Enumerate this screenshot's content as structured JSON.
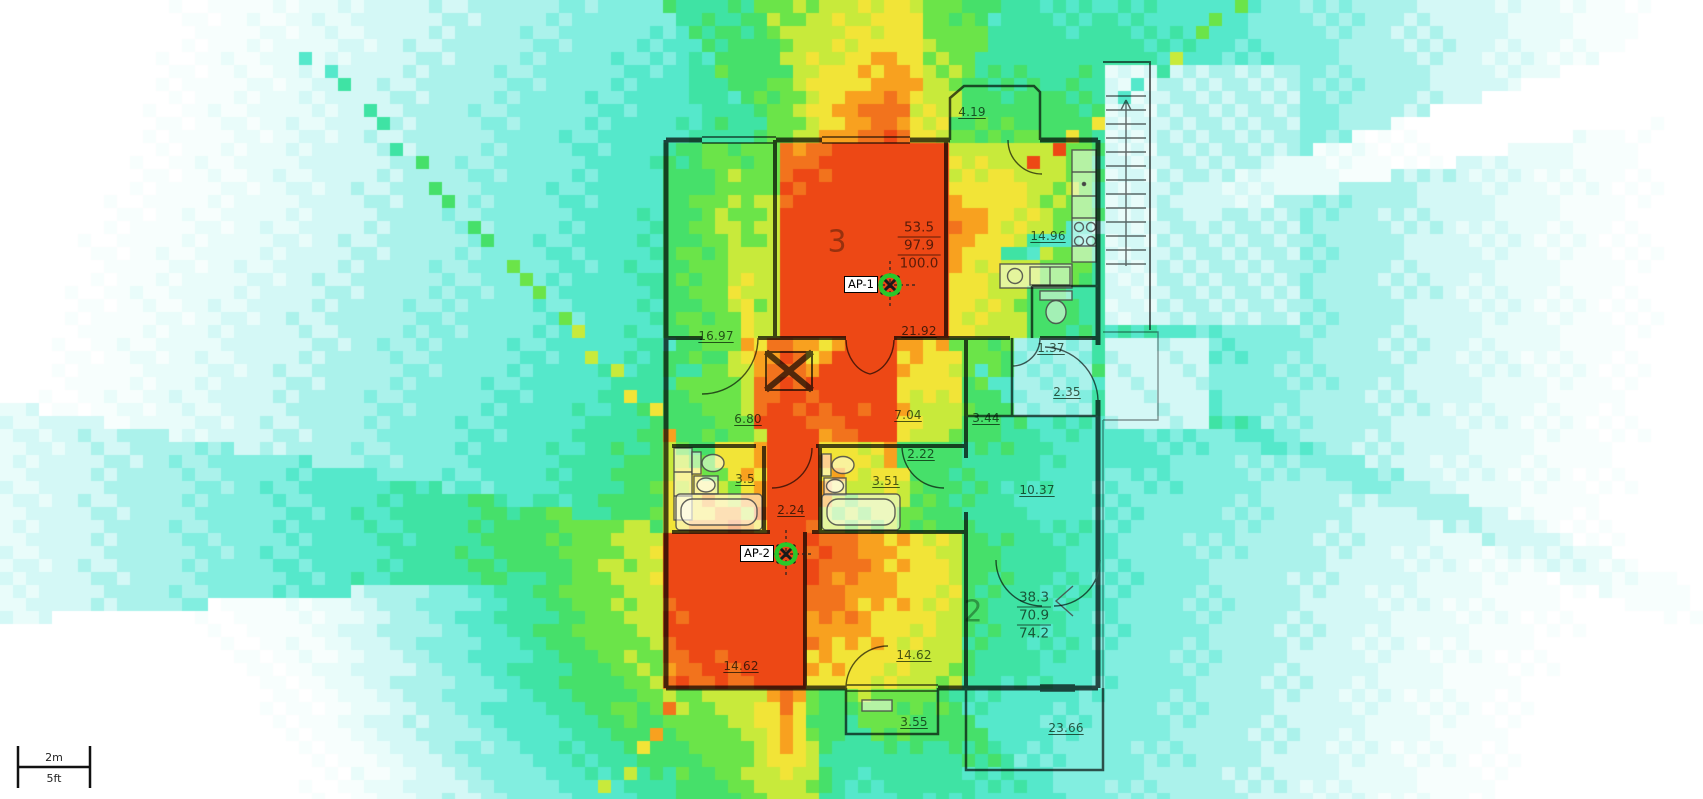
{
  "heatmap": {
    "aps": [
      {
        "label": "AP-1",
        "x": 890,
        "y": 285
      },
      {
        "label": "AP-2",
        "x": 786,
        "y": 554
      }
    ],
    "cell_size": 13,
    "palette": [
      {
        "min": 86,
        "color": "#ED4815"
      },
      {
        "min": 80,
        "color": "#F2731D"
      },
      {
        "min": 75,
        "color": "#F8A11F"
      },
      {
        "min": 68,
        "color": "#F2E437"
      },
      {
        "min": 61,
        "color": "#C8EA3B"
      },
      {
        "min": 53,
        "color": "#6BE449"
      },
      {
        "min": 45,
        "color": "#46E06A"
      },
      {
        "min": 37,
        "color": "#3FE3A4"
      },
      {
        "min": 29,
        "color": "#55E8CB"
      },
      {
        "min": 21,
        "color": "#82EEE0"
      },
      {
        "min": 13,
        "color": "#ABF2EB"
      },
      {
        "min": 6,
        "color": "#D4F8F6"
      },
      {
        "min": 0,
        "color": "#E9FCFA"
      },
      {
        "min": -6,
        "color": "#F7FEFD"
      },
      {
        "min": -999,
        "color": "#FFFFFF"
      }
    ],
    "marker_ring_color": "#29C829"
  },
  "annotations": {
    "room_numbers": [
      {
        "text": "3",
        "x": 837,
        "y": 242
      },
      {
        "text": "2",
        "x": 973,
        "y": 612
      }
    ],
    "area_stats": [
      {
        "lines": [
          "53.5",
          "97.9",
          "100.0"
        ],
        "x": 919,
        "y": 246
      },
      {
        "lines": [
          "38.3",
          "70.9",
          "74.2"
        ],
        "x": 1034,
        "y": 616
      }
    ],
    "measurements": [
      {
        "text": "4.19",
        "x": 972,
        "y": 112
      },
      {
        "text": "16.97",
        "x": 716,
        "y": 336
      },
      {
        "text": "21.92",
        "x": 919,
        "y": 331
      },
      {
        "text": "14.96",
        "x": 1048,
        "y": 236
      },
      {
        "text": "1.37",
        "x": 1051,
        "y": 348
      },
      {
        "text": "2.35",
        "x": 1067,
        "y": 392
      },
      {
        "text": "6.80",
        "x": 748,
        "y": 419
      },
      {
        "text": "7.04",
        "x": 908,
        "y": 415
      },
      {
        "text": "3.44",
        "x": 986,
        "y": 418
      },
      {
        "text": "2.22",
        "x": 921,
        "y": 454
      },
      {
        "text": "3.51",
        "x": 886,
        "y": 481
      },
      {
        "text": "3.5",
        "x": 745,
        "y": 479
      },
      {
        "text": "2.24",
        "x": 791,
        "y": 510
      },
      {
        "text": "10.37",
        "x": 1037,
        "y": 490
      },
      {
        "text": "14.62",
        "x": 741,
        "y": 666
      },
      {
        "text": "14.62",
        "x": 914,
        "y": 655
      },
      {
        "text": "3.55",
        "x": 914,
        "y": 722
      },
      {
        "text": "23.66",
        "x": 1066,
        "y": 728
      }
    ]
  },
  "scale_bar": {
    "metric": "2m",
    "imperial": "5ft"
  }
}
